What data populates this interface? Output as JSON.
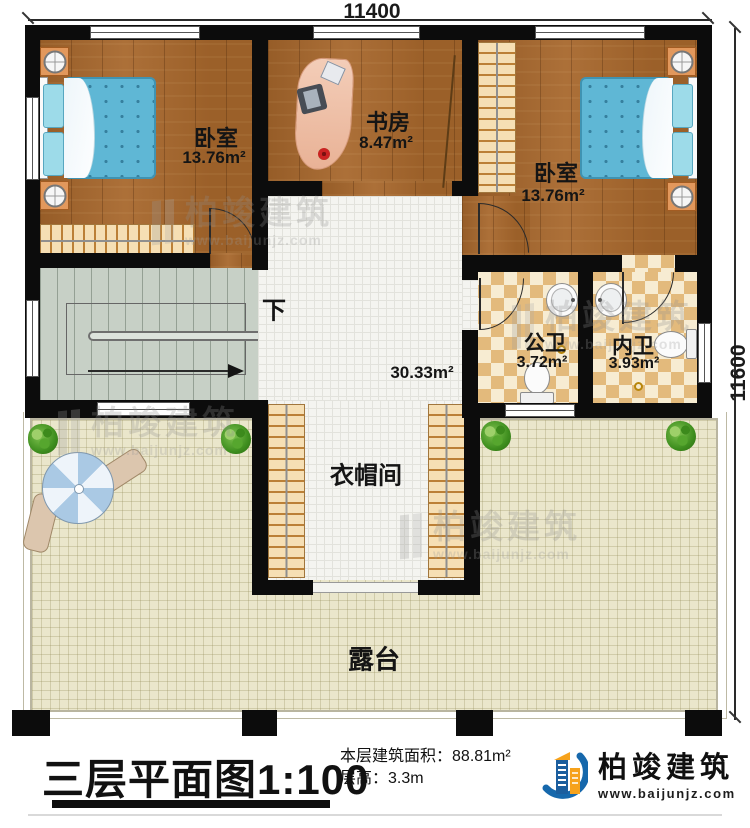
{
  "plan": {
    "dim_top": "11400",
    "dim_right": "11600",
    "rooms": {
      "bedroom_left": {
        "name": "卧室",
        "area": "13.76m²"
      },
      "study": {
        "name": "书房",
        "area": "8.47m²"
      },
      "bedroom_right": {
        "name": "卧室",
        "area": "13.76m²"
      },
      "public_bath": {
        "name": "公卫",
        "area": "3.72m²"
      },
      "inner_bath": {
        "name": "内卫",
        "area": "3.93m²"
      },
      "hall": {
        "area": "30.33m²"
      },
      "cloakroom": {
        "name": "衣帽间"
      },
      "terrace": {
        "name": "露台"
      },
      "stairs": {
        "direction": "下"
      }
    }
  },
  "titleblock": {
    "title": "三层平面图",
    "scale": "1:100",
    "area_label": "本层建筑面积：",
    "area_value": "88.81m²",
    "floor_height_label": "层高：",
    "floor_height_value": "3.3m"
  },
  "branding": {
    "name": "柏竣建筑",
    "url": "www.baijunjz.com"
  }
}
